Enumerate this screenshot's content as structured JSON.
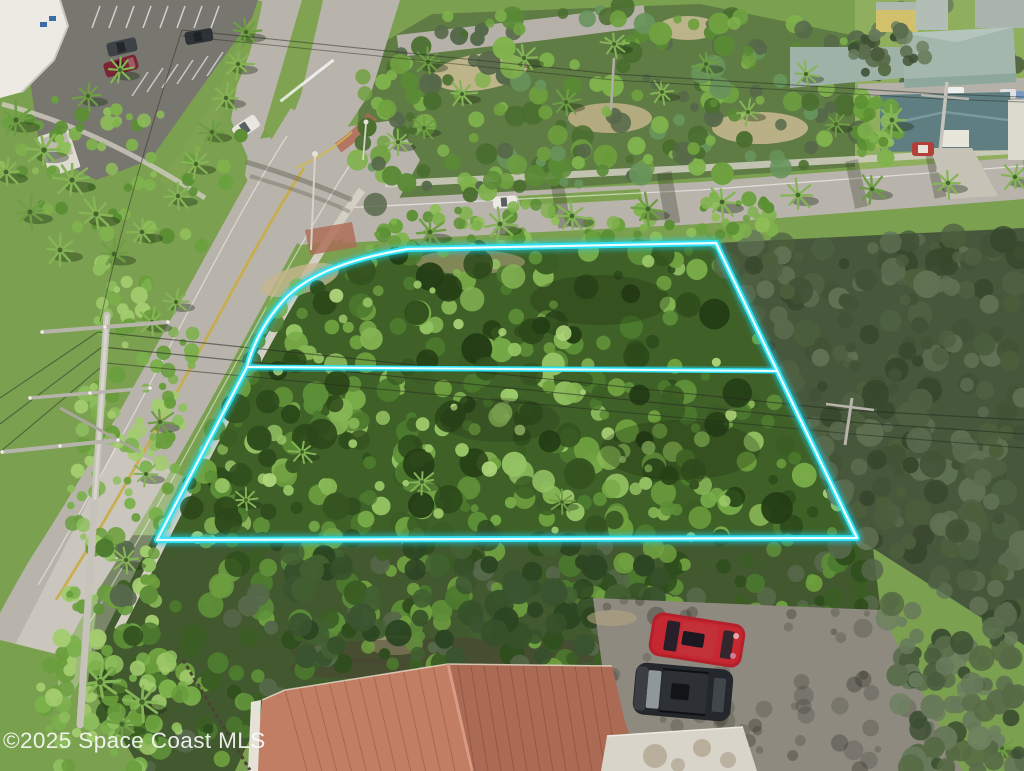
{
  "meta": {
    "type": "aerial-photograph",
    "subject": "vacant wooded parcel outlined with a highlighted property boundary, bordered by roads, palm trees, parking lots and beach-town homes"
  },
  "watermark": {
    "text": "©2025 Space Coast MLS",
    "color": "#fbfbfb"
  },
  "boundary": {
    "name": "property-boundary",
    "stroke_color": "#2ee2f4",
    "core_color": "#ecfeff",
    "glow_color": "#1bd1ec",
    "segments": [
      "parcel-outline",
      "lot-divider"
    ]
  },
  "scene": {
    "road_color": "#b8b4ab",
    "parking_color": "#77766f",
    "grass_color": "#7ca24f",
    "sand_color": "#c7b78f",
    "tile_roof_color": "#b06f59",
    "flat_roof_color": "#d8d4ca",
    "sage_roof_color": "#a4b7ad",
    "teal_roof_color": "#5f7e81",
    "yellow_house_color": "#d2c06b",
    "red_car_color": "#b5212b",
    "black_suv_color": "#24272b",
    "objects": [
      "wooded-lot",
      "lot-divider",
      "divided-highway",
      "side-street",
      "parking-lot",
      "white-building",
      "guard-shack",
      "power-pole",
      "power-lines",
      "palm-trees",
      "tile-roof-house",
      "flat-roof-building",
      "red-suv",
      "black-suv",
      "beach-houses",
      "watermark"
    ]
  }
}
